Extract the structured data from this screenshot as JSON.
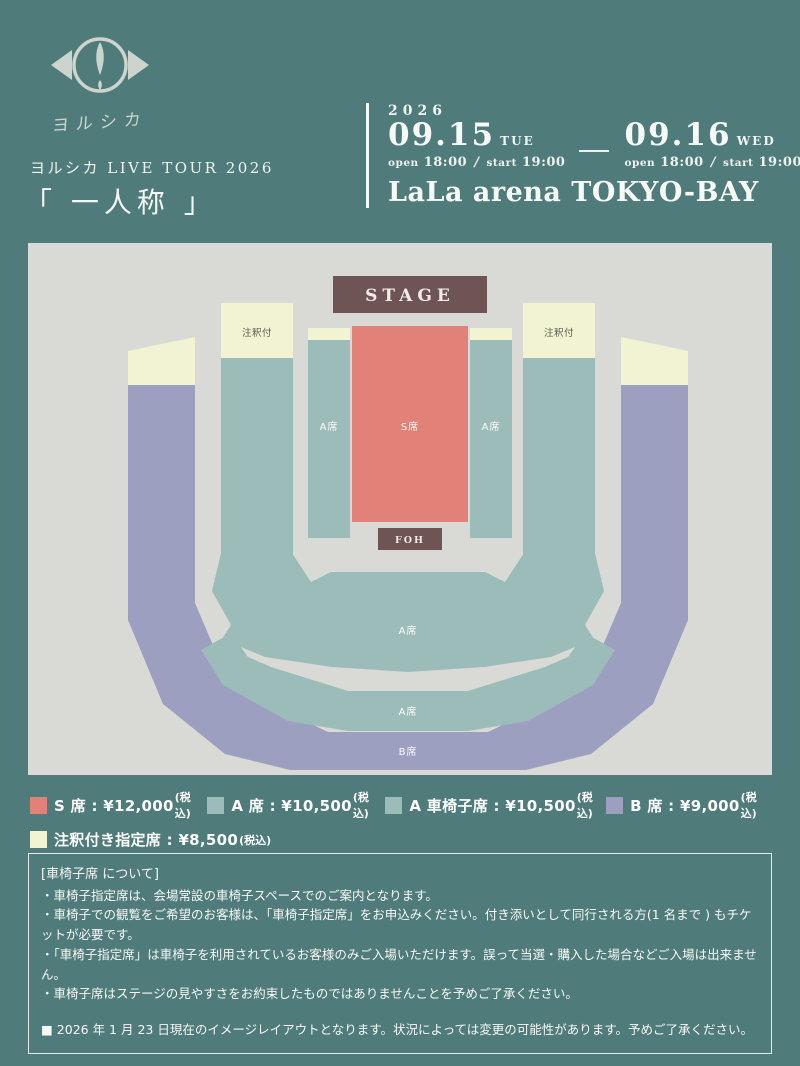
{
  "theme": {
    "background": "#4f7c7a",
    "map_background": "#d9dad6",
    "stage_color": "#6f5455",
    "s_seat_color": "#e28177",
    "a_seat_color": "#9cbcb9",
    "b_seat_color": "#9d9fc0",
    "annotated_seat_color": "#f2f3d2",
    "text_color": "#ffffff"
  },
  "header": {
    "logo_text": "ヨルシカ",
    "tour_label": "ヨルシカ LIVE TOUR 2026",
    "tour_title": "「 一人称 」",
    "year": "2026",
    "dates": [
      {
        "date": "09.15",
        "dow": "TUE",
        "open_label": "open",
        "open_value": "18:00",
        "sep": "/",
        "start_label": "start",
        "start_value": "19:00"
      },
      {
        "date": "09.16",
        "dow": "WED",
        "open_label": "open",
        "open_value": "18:00",
        "sep": "/",
        "start_label": "start",
        "start_value": "19:00"
      }
    ],
    "venue": "LaLa arena TOKYO-BAY"
  },
  "map": {
    "stage_label": "STAGE",
    "foh_label": "FOH",
    "s_label": "S席",
    "a_label": "A席",
    "b_label": "B席",
    "annotated_label": "注釈付"
  },
  "legend": {
    "items": [
      {
        "color": "#e28177",
        "text": "S 席 : ¥12,000",
        "tax": "(税込)"
      },
      {
        "color": "#9cbcb9",
        "text": "A 席 : ¥10,500",
        "tax": "(税込)"
      },
      {
        "color": "#9cbcb9",
        "text": "A 車椅子席 : ¥10,500",
        "tax": "(税込)"
      },
      {
        "color": "#9d9fc0",
        "text": "B 席 : ¥9,000",
        "tax": "(税込)"
      },
      {
        "color": "#f2f3d2",
        "text": "注釈付き指定席 : ¥8,500",
        "tax": "(税込)"
      }
    ]
  },
  "notes": {
    "title": "[車椅子席 について]",
    "items": [
      "・車椅子指定席は、会場常設の車椅子スペースでのご案内となります。",
      "・車椅子での観覧をご希望のお客様は、「車椅子指定席」をお申込みください。付き添いとして同行される方(1 名まで ) もチケットが必要です。",
      "・「車椅子指定席」は車椅子を利用されているお客様のみご入場いただけます。誤って当選・購入した場合などご入場は出来ません。",
      "・車椅子席はステージの見やすさをお約束したものではありませんことを予めご了承ください。"
    ],
    "footnote": "■ 2026 年 1 月 23 日現在のイメージレイアウトとなります。状況によっては変更の可能性があります。予めご了承ください。"
  }
}
